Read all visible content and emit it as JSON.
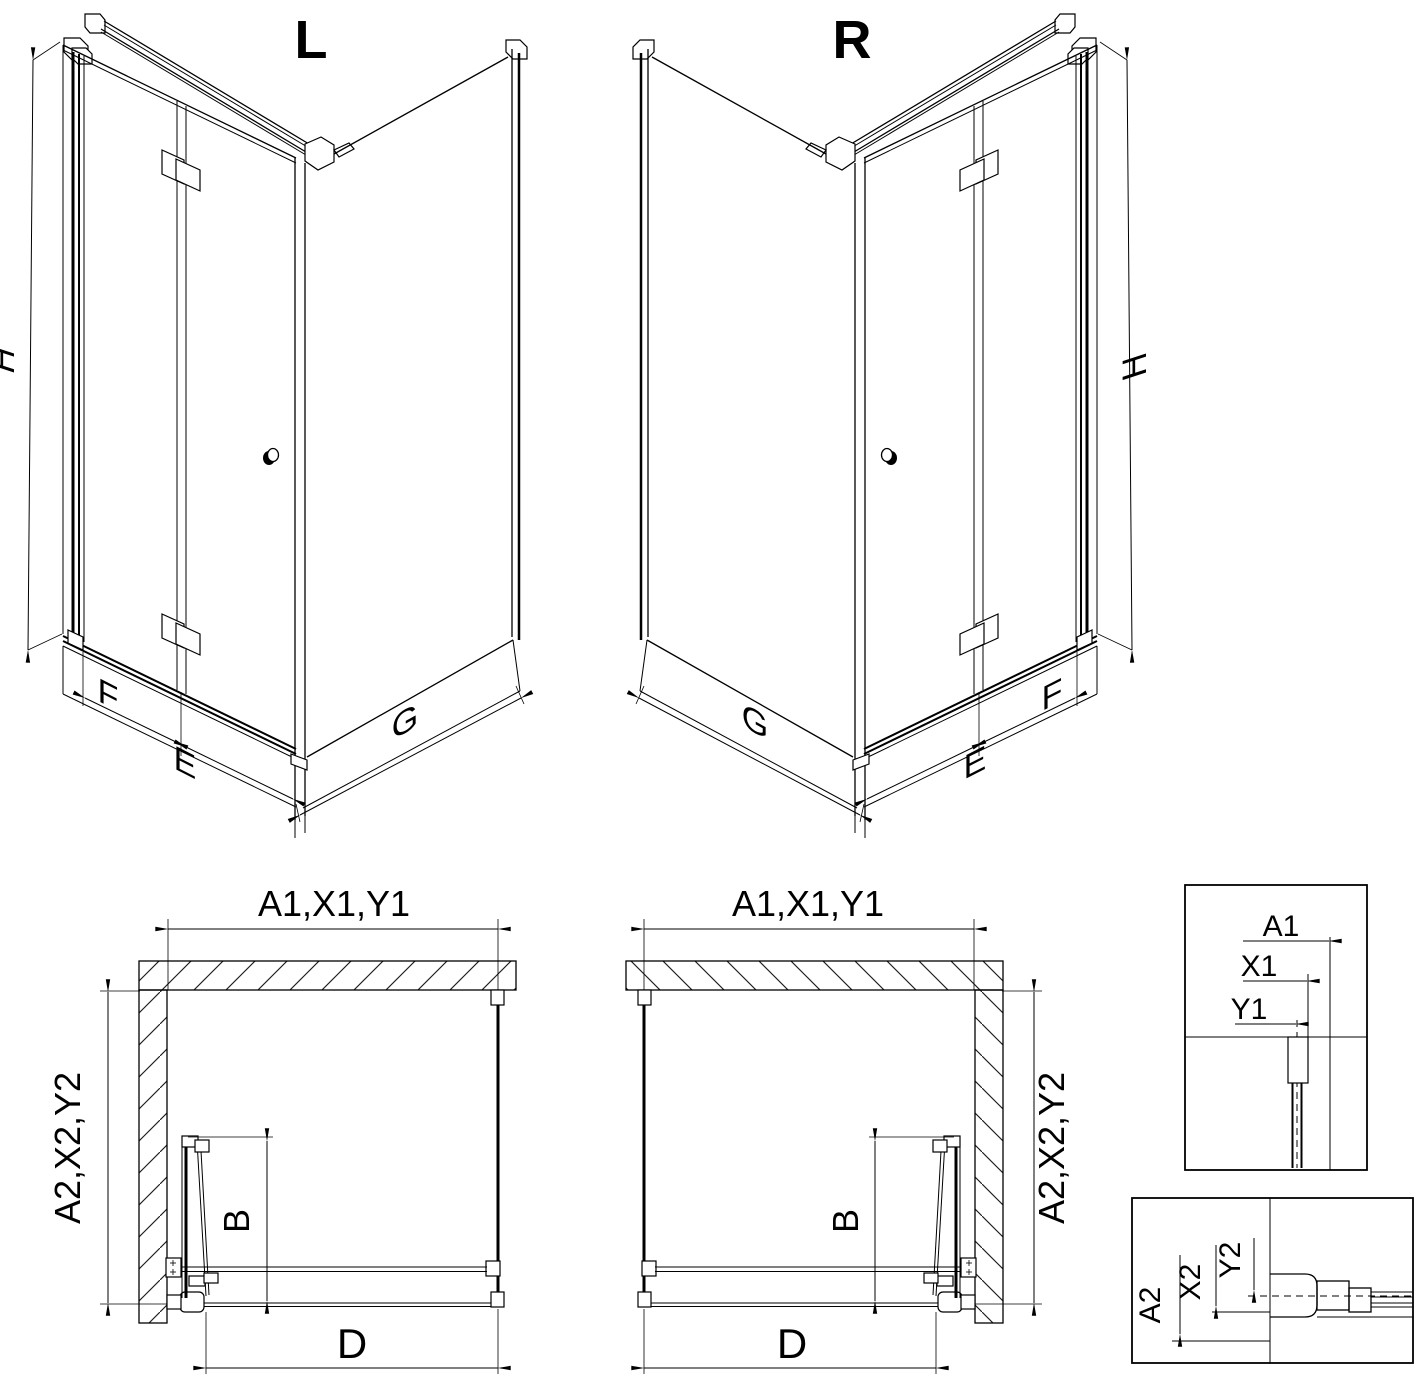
{
  "diagram": {
    "iso_left": {
      "label": "L",
      "height_dim": "H",
      "fixed_dim": "F",
      "door_dim": "E",
      "side_dim": "G"
    },
    "iso_right": {
      "label": "R",
      "height_dim": "H",
      "fixed_dim": "F",
      "door_dim": "E",
      "side_dim": "G"
    },
    "plan_left": {
      "top_dim": "A1,X1,Y1",
      "side_dim": "A2,X2,Y2",
      "door_dim": "B",
      "width_dim": "D"
    },
    "plan_right": {
      "top_dim": "A1,X1,Y1",
      "side_dim": "A2,X2,Y2",
      "door_dim": "B",
      "width_dim": "D"
    },
    "detail_top": {
      "dim_a": "A1",
      "dim_x": "X1",
      "dim_y": "Y1"
    },
    "detail_bottom": {
      "dim_a": "A2",
      "dim_x": "X2",
      "dim_y": "Y2"
    },
    "colors": {
      "line": "#000000",
      "background": "#ffffff"
    }
  }
}
